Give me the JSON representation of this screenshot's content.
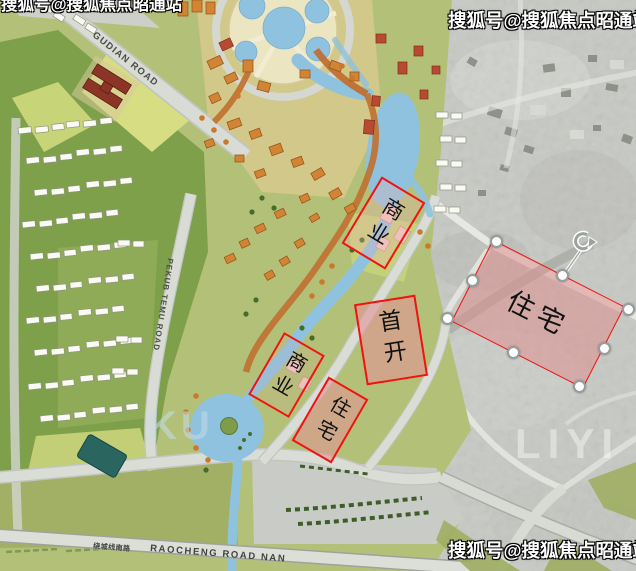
{
  "watermarks": {
    "sohu": "搜狐号@搜狐焦点昭通站"
  },
  "faint_marks": {
    "a": "KU",
    "b": "LIYI"
  },
  "road_labels": {
    "gudian": "GUDIAN ROAD",
    "west_vertical": "PEKUB TEMU ROAD",
    "south_cn": "绕城线南路",
    "south_en": "RAOCHENG ROAD NAN"
  },
  "zones": [
    {
      "id": "commercial-north",
      "label": "商业"
    },
    {
      "id": "first-launch",
      "label": "首开"
    },
    {
      "id": "residential-mid",
      "label": "住宅"
    },
    {
      "id": "commercial-south",
      "label": "商业"
    },
    {
      "id": "residential-east-selected",
      "label": "住宅"
    }
  ],
  "colors": {
    "zone_border": "#ef1410",
    "zone_fill_pink": "#e19494",
    "water": "#8fc2de",
    "road": "#d9dbd5",
    "handle_stroke": "#979d9c"
  }
}
